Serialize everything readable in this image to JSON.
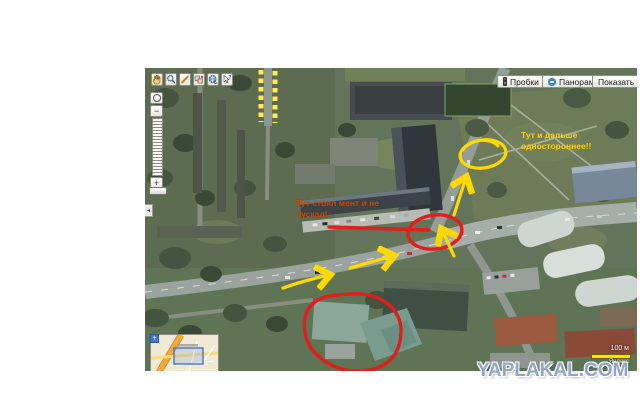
{
  "watermark": {
    "text": "YAPLAKAL.COM"
  },
  "toolbar": {
    "icons": [
      "pan-hand",
      "zoom-area",
      "measure-ruler",
      "edit-objects",
      "map-type-globe",
      "identify-cursor"
    ]
  },
  "header_buttons": {
    "traffic": "Пробки",
    "panoramas": "Панорамы",
    "show": "Показать",
    "show_caret": "▾"
  },
  "zoom_control": {
    "minus": "−",
    "plus": "+",
    "collapse": "◂"
  },
  "scale": {
    "label": "100 м",
    "attribution": "Яндекс"
  },
  "annotations": {
    "oneway_line1": "Тут и дальше",
    "oneway_line2": "одностороннее!!",
    "cop_line1": "Тут стоял мент и не",
    "cop_line2": "пускал!",
    "red_color": "#e11d1d",
    "yellow_color": "#ffd900",
    "oneway_text_color": "#ffd900",
    "cop_text_color": "#d04a00"
  }
}
